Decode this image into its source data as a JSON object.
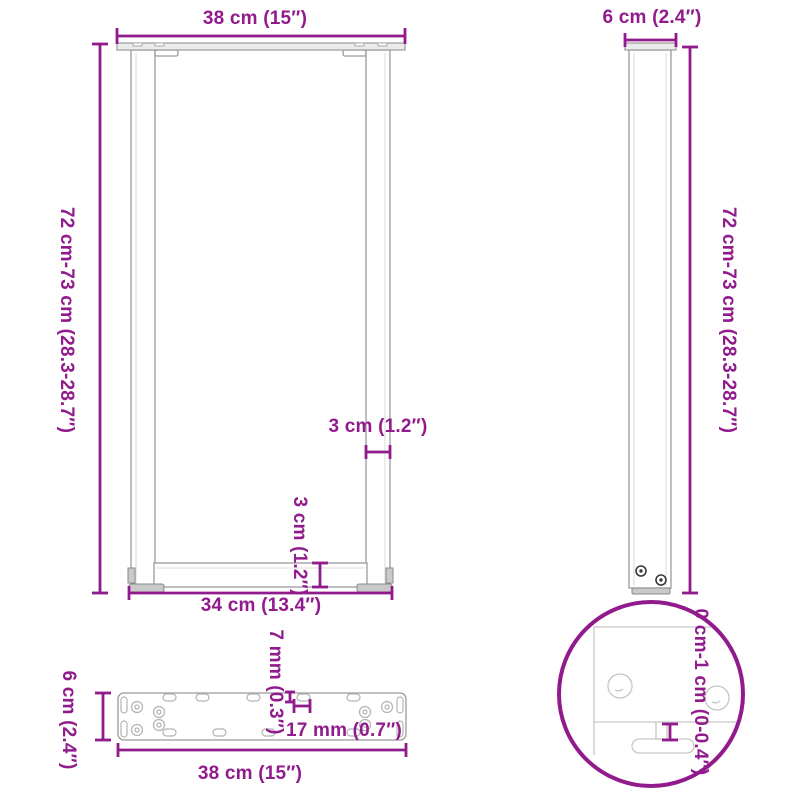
{
  "colors": {
    "accent": "#911b8c",
    "bg": "#ffffff",
    "drawing_line": "#9a9a9a",
    "detail_line": "#c6c6c6"
  },
  "views": {
    "front": {
      "top_width": "38 cm (15″)",
      "height": "72 cm-73 cm (28.3-28.7″)",
      "leg_thickness": "3 cm (1.2″)",
      "crossbar_thickness": "3 cm (1.2″)",
      "bottom_width": "34 cm (13.4″)"
    },
    "side": {
      "depth": "6 cm (2.4″)",
      "height": "72 cm-73 cm (28.3-28.7″)"
    },
    "foot_detail": {
      "adjustable_range": "0 cm-1 cm (0-0.4″)"
    },
    "mounting_plate": {
      "depth": "6 cm (2.4″)",
      "slot_width": "7 mm (0.3″)",
      "slot_length": "17 mm (0.7″)",
      "length": "38 cm (15″)"
    }
  }
}
